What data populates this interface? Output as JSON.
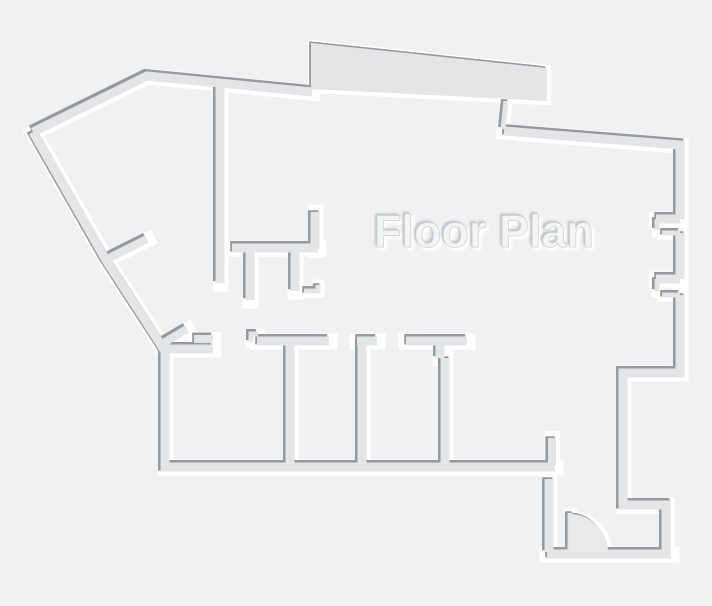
{
  "page": {
    "width": 712,
    "height": 606,
    "background": "#f0f1f2"
  },
  "floorplan": {
    "title": "Floor Plan",
    "colors": {
      "wall_fill": "#e3e5e6",
      "wall_shadow": "#979a9d",
      "wall_highlight": "#ffffff",
      "door_fill": "#e7e9ea",
      "slab_fill": "#e3e5e6",
      "title_fill": "#f3f4f5",
      "title_shadow": "#c3c6c8",
      "title_glow": "#ffffff"
    },
    "shadow_offset": {
      "x": -1.8,
      "y": -1.8
    },
    "walls": [
      {
        "name": "outer-wall-top-left",
        "d": "M33,132 L147,76 L312,92",
        "w": 9
      },
      {
        "name": "outer-wall-left-and-bottom",
        "d": "M33,132 L106,260 L165,351 L165,467 L555,467",
        "w": 9
      },
      {
        "name": "roof-step-jamb",
        "d": "M506,101 L503,129",
        "w": 5
      },
      {
        "name": "outer-wall-top-right",
        "d": "M504,131 L680,145 L680,219",
        "w": 9
      },
      {
        "name": "right-wall-middle",
        "d": "M680,233 L680,279",
        "w": 9
      },
      {
        "name": "right-wall-lower",
        "d": "M680,295 L680,373 L623,373 L623,505 L666,505 L666,552",
        "w": 9
      },
      {
        "name": "entry-bottom-wall",
        "d": "M671,554 L547,554",
        "w": 9
      },
      {
        "name": "entry-left-wall",
        "d": "M549,479 L549,552",
        "w": 9
      },
      {
        "name": "entry-jamb-stub",
        "d": "M552,438 L552,465",
        "w": 8
      },
      {
        "name": "hall-wall-vertical",
        "d": "M220,84 L220,283",
        "w": 9
      },
      {
        "name": "closet-shelf-wall",
        "d": "M232,248 L318,248",
        "w": 9
      },
      {
        "name": "closet-wall-a",
        "d": "M250,249 L250,300",
        "w": 9
      },
      {
        "name": "closet-wall-b",
        "d": "M295,249 L295,291",
        "w": 9
      },
      {
        "name": "closet-riser-wall",
        "d": "M315,212 L315,249",
        "w": 9
      },
      {
        "name": "closet-hook-jamb",
        "d": "M304,291 L318,291 L318,285",
        "w": 5
      },
      {
        "name": "window-notch-1-top",
        "d": "M656,219 L680,219",
        "w": 9
      },
      {
        "name": "window-notch-1-side",
        "d": "M657,219 L657,230",
        "w": 5
      },
      {
        "name": "window-notch-1-bottom",
        "d": "M662,233 L680,233",
        "w": 5
      },
      {
        "name": "window-notch-2-top",
        "d": "M656,279 L680,279",
        "w": 9
      },
      {
        "name": "window-notch-2-side",
        "d": "M657,279 L657,291",
        "w": 5
      },
      {
        "name": "window-notch-2-bottom",
        "d": "M662,295 L680,295",
        "w": 5
      },
      {
        "name": "room-a-top-wall",
        "d": "M165,349 L213,349",
        "w": 9
      },
      {
        "name": "room-a-top-lip",
        "d": "M194,339 L213,339",
        "w": 8
      },
      {
        "name": "door-jamb-room-a",
        "d": "M160,345 L187,329",
        "w": 8
      },
      {
        "name": "door-jamb-left-hall",
        "d": "M107,259 L147,239",
        "w": 8
      },
      {
        "name": "door-step-jamb",
        "d": "M258,334 L251,334 L251,342",
        "w": 5
      },
      {
        "name": "band-top-wall",
        "d": "M257,341 L329,341",
        "w": 9
      },
      {
        "name": "partition-1",
        "d": "M290,341 L290,465",
        "w": 9
      },
      {
        "name": "partition-2",
        "d": "M362,341 L362,465",
        "w": 9
      },
      {
        "name": "partition-2-cap",
        "d": "M357,341 L377,341",
        "w": 9
      },
      {
        "name": "partition-3-cap",
        "d": "M406,341 L467,341",
        "w": 9
      },
      {
        "name": "partition-3-stem",
        "d": "M440,341 L440,358 M445,358 L445,465",
        "w": 9
      },
      {
        "name": "entry-door-leaf",
        "d": "M570,513 L570,551",
        "w": 5
      }
    ],
    "fills": [
      {
        "name": "roof-slab",
        "d": "M311,43 L547,68 L547,101 L311,89 Z",
        "fill": "slab_fill",
        "order": "before"
      },
      {
        "name": "entry-door-swing",
        "d": "M570,553 L570,514 A38,38 0 0 1 608,553 Z",
        "fill": "door_fill",
        "order": "after"
      }
    ]
  }
}
